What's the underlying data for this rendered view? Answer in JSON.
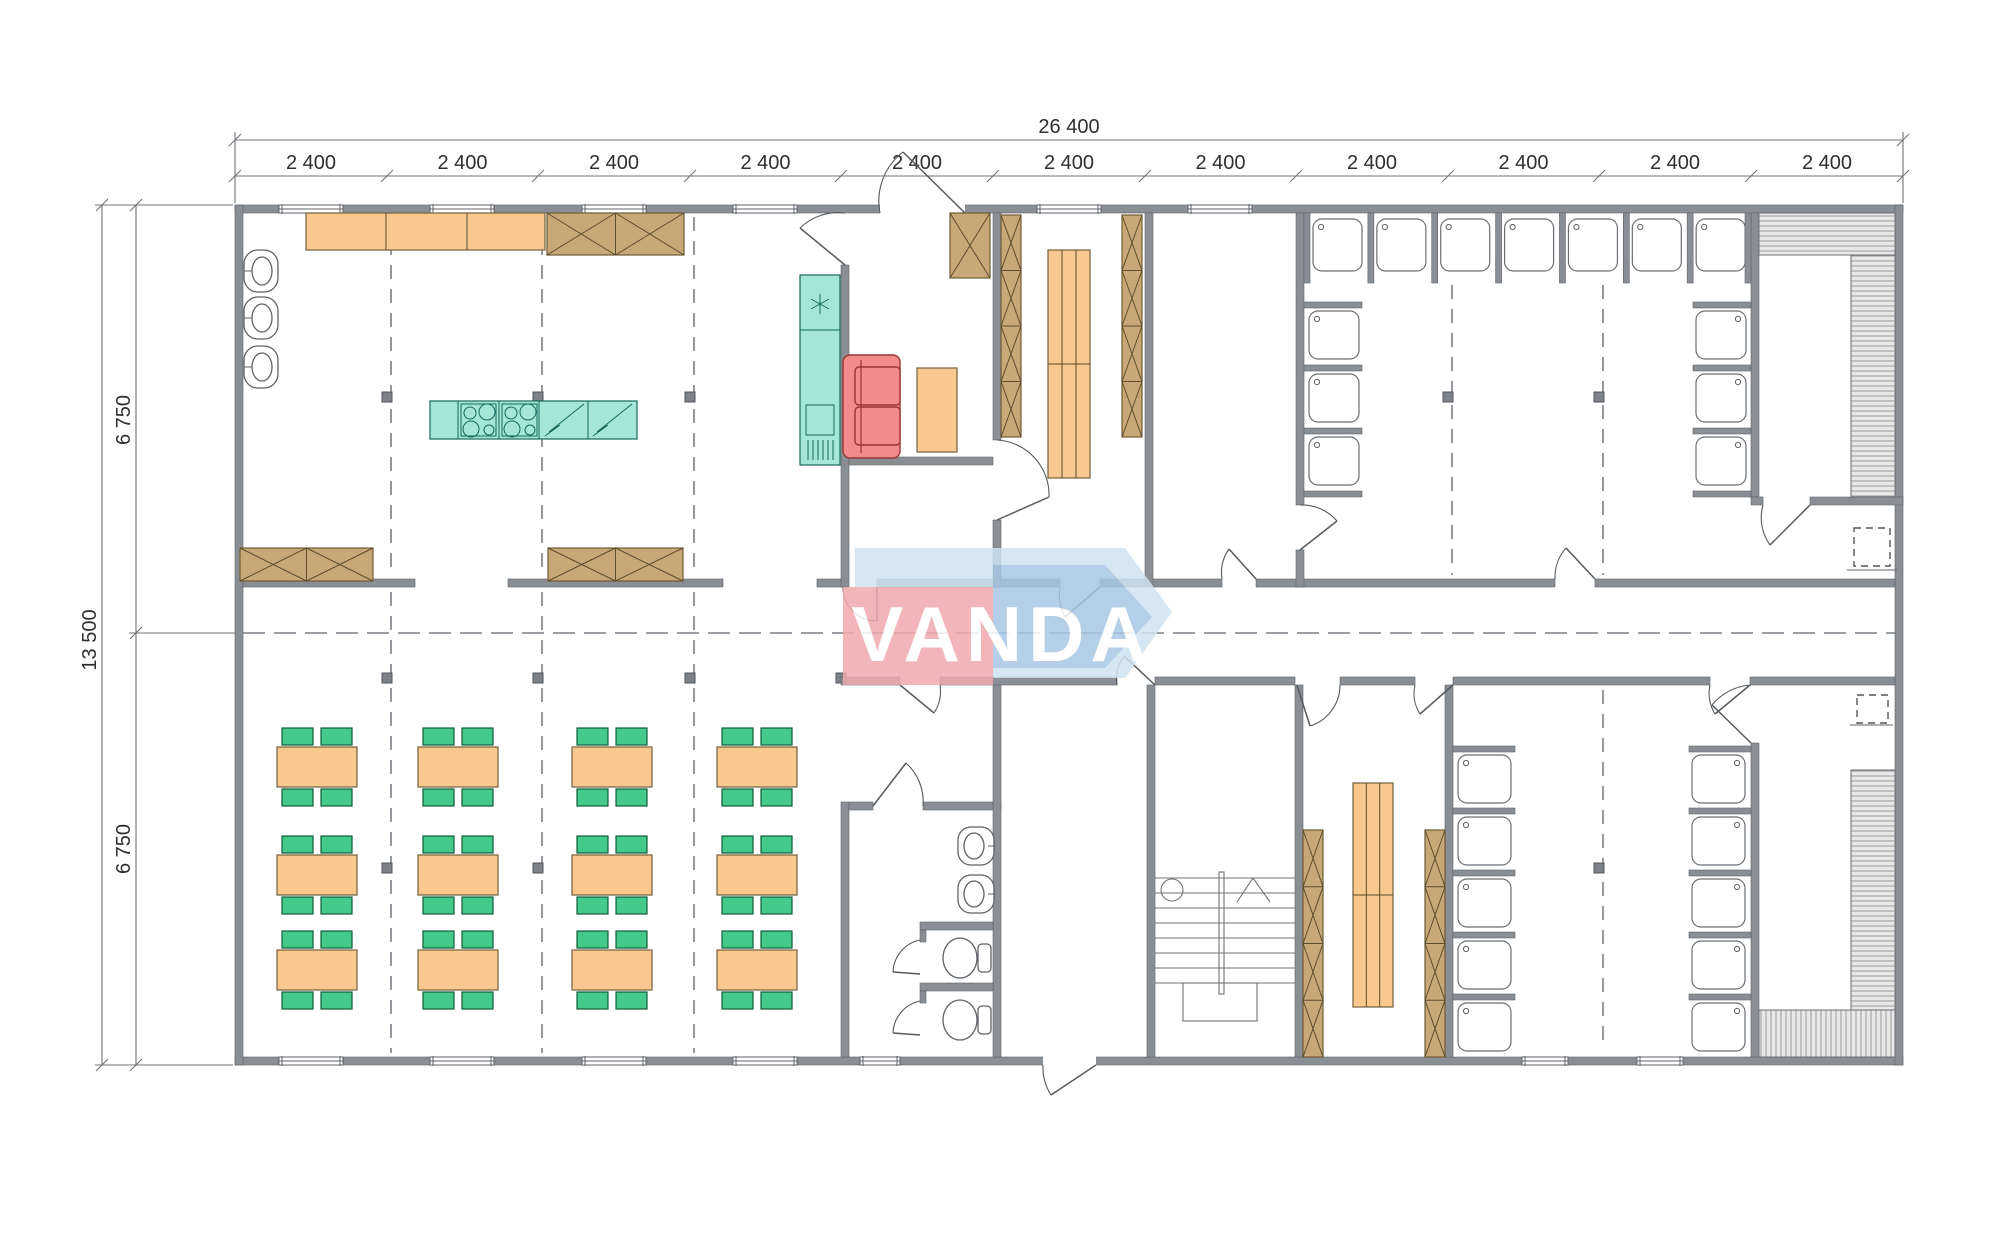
{
  "watermark": {
    "text": "VANDA",
    "red_color": "#f0a9ae",
    "blue_color": "#a9c7e4",
    "light_blue_color": "#cfe2f1"
  },
  "dimensions": {
    "overall_width": "26 400",
    "bay_segments": [
      "2 400",
      "2 400",
      "2 400",
      "2 400",
      "2 400",
      "2 400",
      "2 400",
      "2 400",
      "2 400",
      "2 400",
      "2 400"
    ],
    "overall_height": "13 500",
    "height_segments": [
      "6 750",
      "6 750"
    ]
  },
  "fixtures": {
    "dining_tables": {
      "rows": 3,
      "cols": 4,
      "chairs_per_table": 4
    },
    "kitchen": {
      "wall_basins": 3,
      "counter_sections": 3,
      "crossed_counter_cells": 2,
      "island_cooktops": 2
    },
    "wc": {
      "basins": 2,
      "toilets": 2
    },
    "showers": {
      "top_row": 7,
      "upper_left_column": 3,
      "upper_right_column": 3,
      "lower_left_column": 5,
      "lower_right_column": 5
    },
    "lockers": {
      "cells_per_strip": 4
    },
    "benches": 2,
    "saunas": 2,
    "stairs_treads": 8
  },
  "colors": {
    "wall": "#8a8f95",
    "furniture_orange": "#f8c88e",
    "cabinet_brown": "#c9a877",
    "appliance_teal": "#a5e6d6",
    "sofa_red": "#f28b8b",
    "chair_green": "#43c98a",
    "dim_text": "#2f2f2f"
  }
}
